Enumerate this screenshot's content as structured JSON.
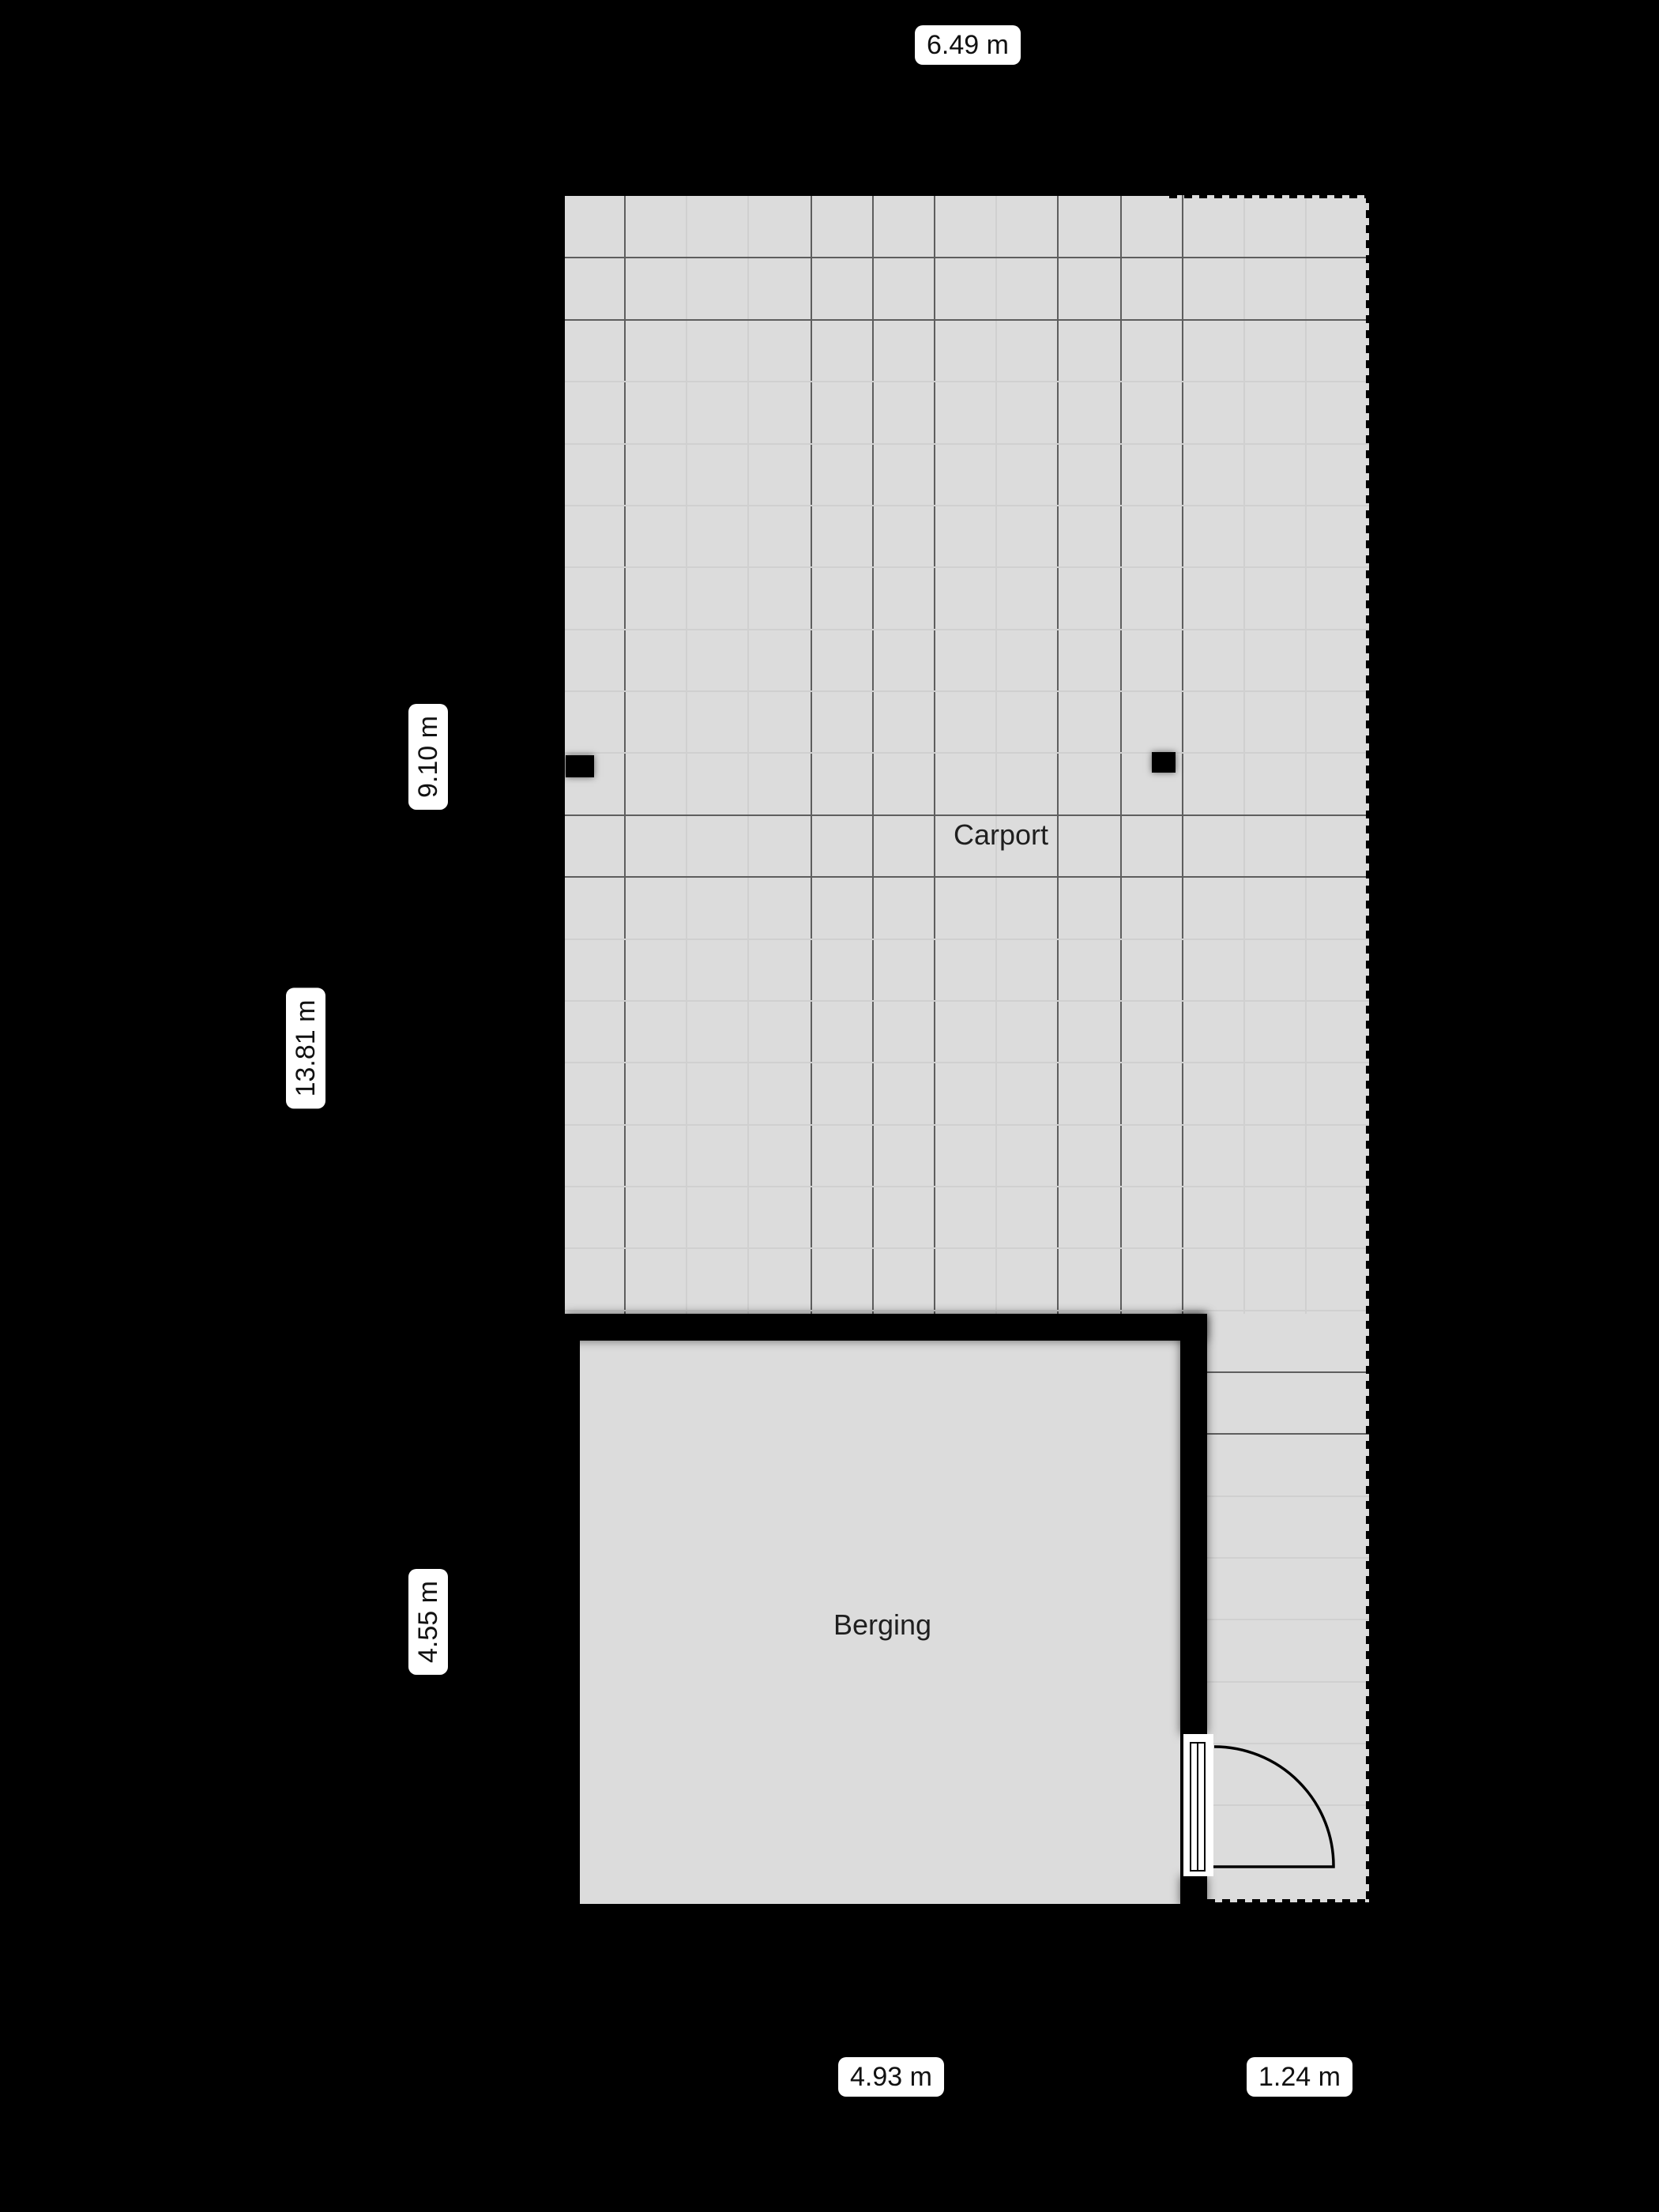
{
  "floorplan": {
    "rooms": [
      {
        "name": "Carport"
      },
      {
        "name": "Berging"
      }
    ],
    "dimensions": {
      "top_width": "6.49 m",
      "left_upper_height": "9.10 m",
      "left_total_height": "13.81 m",
      "left_lower_height": "4.55 m",
      "bottom_left_width": "4.93 m",
      "bottom_right_width": "1.24 m"
    },
    "colors": {
      "bg": "#000000",
      "floor": "#dcdcdc",
      "grid-dark": "#5e5e5e",
      "grid-light": "#d0d0d0",
      "wall": "#000000",
      "label-bg": "#ffffff",
      "label-text": "#111111",
      "room-text": "#1f1f1f"
    }
  }
}
